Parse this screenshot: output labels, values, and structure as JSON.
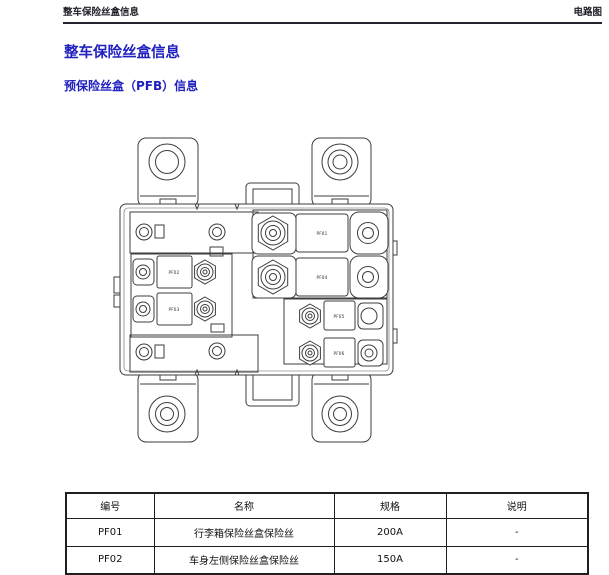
{
  "header": {
    "left": "整车保险丝盒信息",
    "right": "电路图"
  },
  "title": "整车保险丝盒信息",
  "subtitle": "预保险丝盒（PFB）信息",
  "diagram": {
    "description": "预保险丝盒线条图",
    "labels": {
      "pf01": "PF01",
      "pf02": "PF02",
      "pf03": "PF03",
      "pf04": "PF04",
      "pf05": "PF05",
      "pf06": "PF06"
    }
  },
  "table": {
    "columns": [
      "编号",
      "名称",
      "规格",
      "说明"
    ],
    "rows": [
      [
        "PF01",
        "行李箱保险丝盒保险丝",
        "200A",
        "-"
      ],
      [
        "PF02",
        "车身左侧保险丝盒保险丝",
        "150A",
        "-"
      ]
    ]
  },
  "colors": {
    "accent_blue": "#2020c0",
    "line": "#3d3d3d"
  }
}
